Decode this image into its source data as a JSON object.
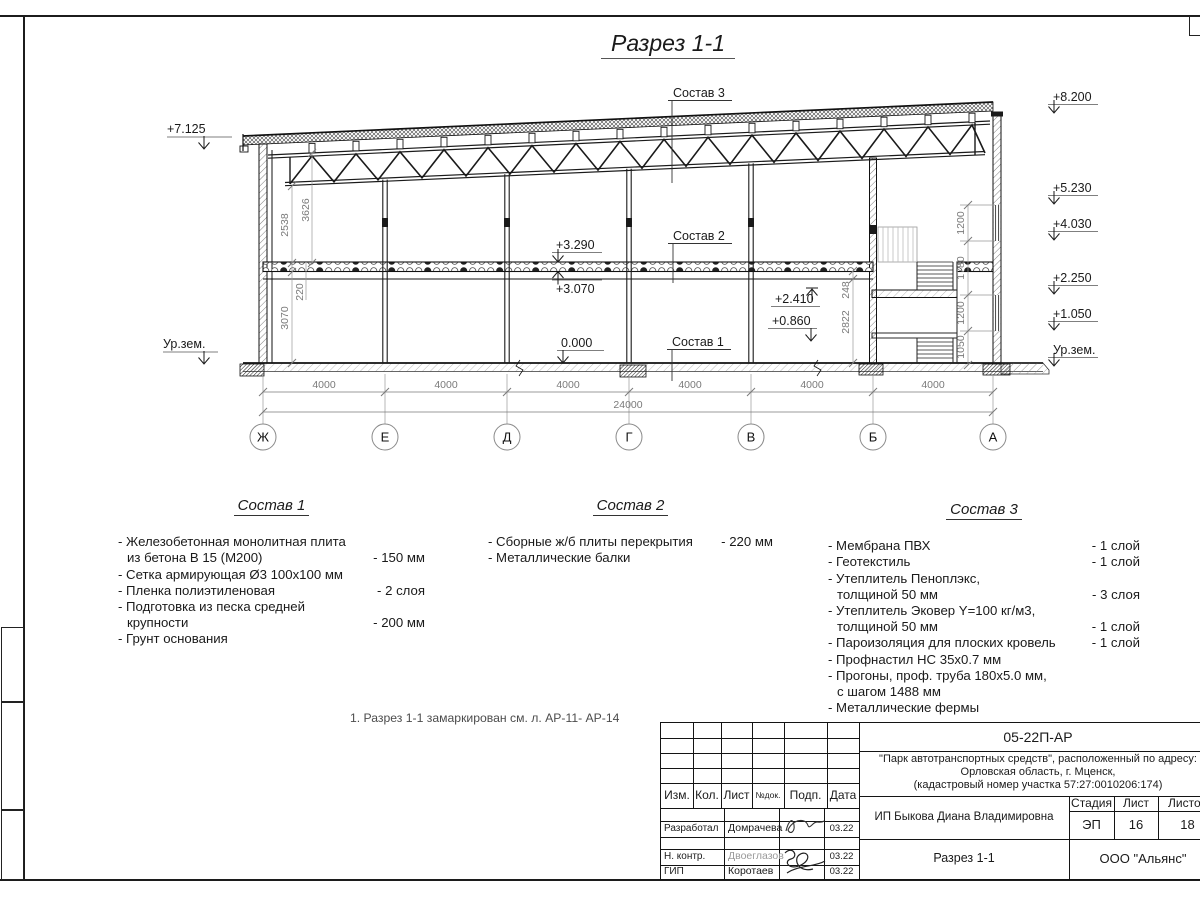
{
  "page": {
    "title": "Разрез 1-1",
    "note": "1. Разрез 1-1 замаркирован см. л. АР-11- АР-14"
  },
  "drawing": {
    "callout_1": "Состав 1",
    "callout_2": "Состав 2",
    "callout_3": "Состав 3",
    "elev_left_roof": "+7.125",
    "ground_left": "Ур.зем.",
    "ground_right": "Ур.зем.",
    "elev_right": [
      "+8.200",
      "+5.230",
      "+4.030",
      "+2.250",
      "+1.050"
    ],
    "elev_slab_top": "+3.290",
    "elev_slab_bot": "+3.070",
    "elev_zero": "0.000",
    "elev_mezz_top": "+2.410",
    "elev_mezz_bot": "+0.860",
    "dims": {
      "left": [
        "2538",
        "3626",
        "220",
        "3070"
      ],
      "right": [
        "248",
        "2822"
      ],
      "chain": [
        "1200",
        "1780",
        "1200",
        "1050"
      ]
    },
    "bays": [
      "4000",
      "4000",
      "4000",
      "4000",
      "4000",
      "4000"
    ],
    "total": "24000",
    "axes": [
      "Ж",
      "Е",
      "Д",
      "Г",
      "В",
      "Б",
      "А"
    ]
  },
  "compositions": [
    {
      "title": "Состав 1",
      "rows": [
        {
          "text": "- Железобетонная  монолитная плита",
          "value": ""
        },
        {
          "text": "из бетона В 15 (М200)",
          "value": "- 150 мм"
        },
        {
          "text": "- Сетка армирующая Ø3 100x100 мм",
          "value": ""
        },
        {
          "text": "- Пленка полиэтиленовая",
          "value": "-  2 слоя"
        },
        {
          "text": "- Подготовка из песка средней",
          "value": ""
        },
        {
          "text": "крупности",
          "value": "- 200 мм"
        },
        {
          "text": "- Грунт основания",
          "value": ""
        }
      ]
    },
    {
      "title": "Состав 2",
      "rows": [
        {
          "text": "- Сборные ж/б плиты перекрытия",
          "value": "- 220 мм"
        },
        {
          "text": "- Металлические балки",
          "value": ""
        }
      ]
    },
    {
      "title": "Состав 3",
      "rows": [
        {
          "text": "- Мембрана ПВХ",
          "value": "- 1 слой"
        },
        {
          "text": "- Геотекстиль",
          "value": "- 1 слой"
        },
        {
          "text": "- Утеплитель Пеноплэкс,",
          "value": ""
        },
        {
          "text": "толщиной 50 мм",
          "value": "- 3 слоя"
        },
        {
          "text": "- Утеплитель Эковер Y=100 кг/м3,",
          "value": ""
        },
        {
          "text": "толщиной 50 мм",
          "value": "- 1 слой"
        },
        {
          "text": "- Пароизоляция для плоских кровель",
          "value": "- 1 слой"
        },
        {
          "text": "- Профнастил НС 35x0.7 мм",
          "value": ""
        },
        {
          "text": "- Прогоны, проф. труба 180x5.0 мм,",
          "value": ""
        },
        {
          "text": "с шагом 1488 мм",
          "value": ""
        },
        {
          "text": "- Металлические фермы",
          "value": ""
        }
      ]
    }
  ],
  "titleblock": {
    "doc_number": "05-22П-АР",
    "project_line1": "\"Парк автотранспортных средств\",  расположенный по адресу:",
    "project_line2": "Орловская область, г. Мценск,",
    "project_line3": "(кадастровый номер участка 57:27:0010206:174)",
    "col_izm": "Изм.",
    "col_kol": "Кол.",
    "col_list": "Лист",
    "col_ndok": "№док.",
    "col_podp": "Подп.",
    "col_data": "Дата",
    "rows": [
      {
        "role": "Разработал",
        "name": "Домрачева",
        "date": "03.22"
      },
      {
        "role": "Н. контр.",
        "name": "Двоеглазов",
        "date": "03.22"
      },
      {
        "role": "ГИП",
        "name": "Коротаев",
        "date": "03.22"
      }
    ],
    "client": "ИП Быкова Диана Владимировна",
    "stage_label": "Стадия",
    "sheet_label": "Лист",
    "sheets_label": "Листов",
    "stage": "ЭП",
    "sheet": "16",
    "sheets": "18",
    "drawing_name": "Разрез 1-1",
    "company": "ООО \"Альянс\""
  }
}
